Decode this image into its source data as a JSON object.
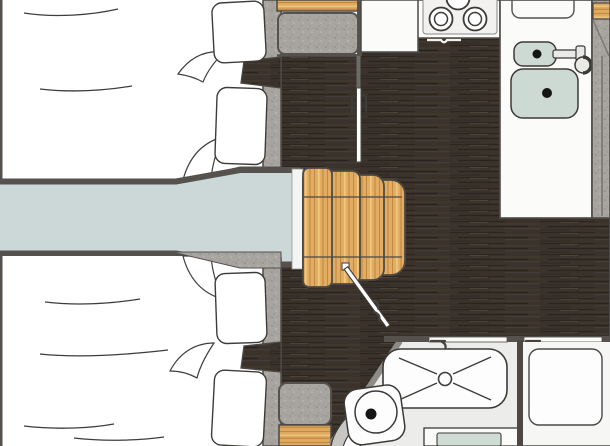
{
  "meta": {
    "title": "Boat / caravan interior floor plan (top view)",
    "kind": "floor-plan"
  },
  "palette": {
    "floor_dark_wood": "#3a322b",
    "wood_light": "#dfaa60",
    "wall_speckle_gray": "#a8a5a0",
    "wall_dark": "#55524d",
    "walkway_blue_gray": "#ccd7d8",
    "sink_basin_green": "#cdd9d3",
    "fixture_white": "#fdfdfd",
    "bathroom_floor": "#ececea",
    "outline_dark": "#3c3a37"
  },
  "rooms": {
    "cabin_fore": {
      "label": "Twin-bed cabin (upper left)",
      "beds": 2,
      "pillows": 2
    },
    "cabin_aft": {
      "label": "Twin-bed cabin (lower left)",
      "beds": 2,
      "pillows": 2
    },
    "walkway": {
      "label": "Center walkway with wooden steps",
      "steps": 4
    },
    "galley": {
      "label": "Galley kitchen",
      "burners_visible": 3,
      "sinks": 2,
      "fixtures": [
        "stove",
        "small-sink",
        "large-sink",
        "faucet",
        "counter",
        "sliding-door"
      ]
    },
    "bathroom": {
      "label": "Bathroom",
      "fixtures": [
        "shower-tray",
        "toilet",
        "vanity-cabinet",
        "door-open"
      ]
    },
    "wardrobe": {
      "label": "Right compartment (wardrobe)"
    }
  }
}
